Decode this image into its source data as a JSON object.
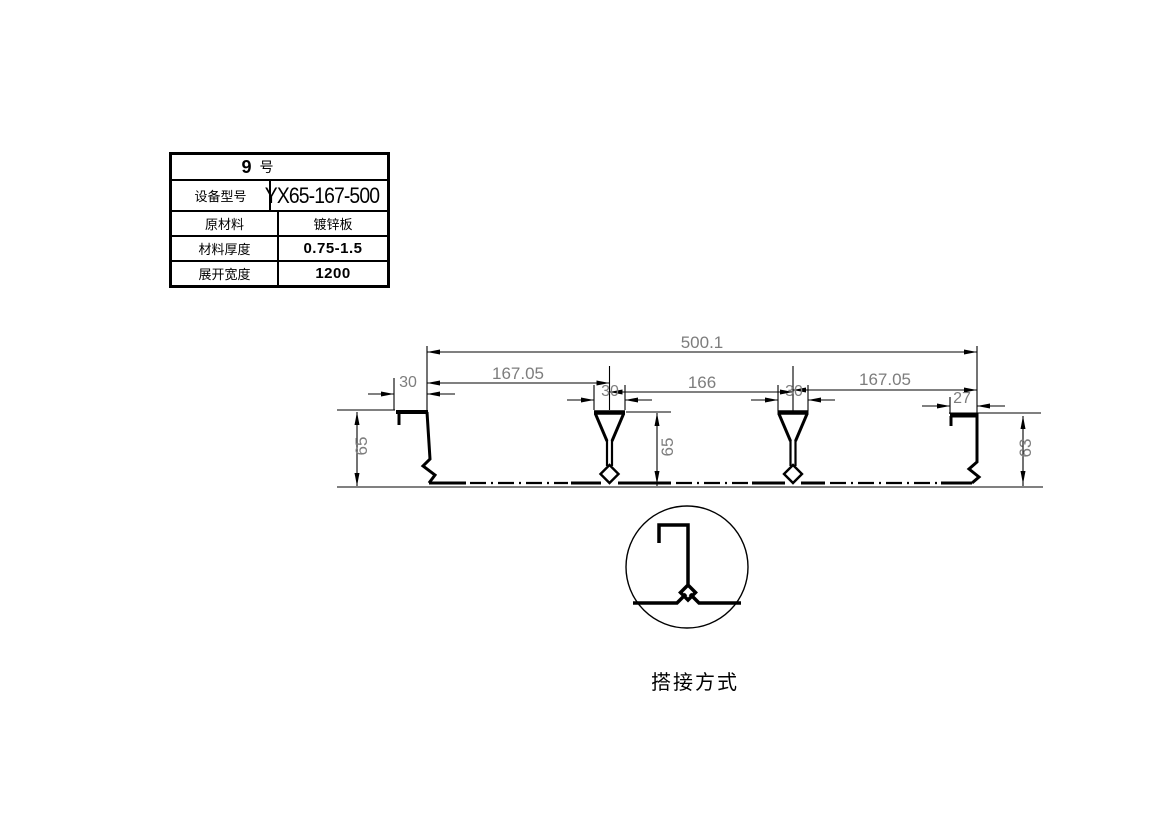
{
  "spec_table": {
    "header": {
      "number": "9",
      "suffix": "号"
    },
    "rows": [
      {
        "label": "设备型号",
        "value": "YX65-167-500"
      },
      {
        "label": "原材料",
        "value": "镀锌板"
      },
      {
        "label": "材料厚度",
        "value": "0.75-1.5"
      },
      {
        "label": "展开宽度",
        "value": "1200"
      }
    ]
  },
  "drawing": {
    "dimensions": {
      "total_width": "500.1",
      "left_span": "167.05",
      "middle_span": "166",
      "right_span": "167.05",
      "left_edge_width": "30",
      "rib1_top_width": "30",
      "rib2_top_width": "30",
      "right_edge_width": "27",
      "left_edge_height": "65",
      "rib_height": "65",
      "right_edge_height": "63"
    },
    "detail_caption": "搭接方式"
  },
  "colors": {
    "line": "#000000",
    "dimension_text": "#7d7d7d",
    "background": "#ffffff"
  }
}
